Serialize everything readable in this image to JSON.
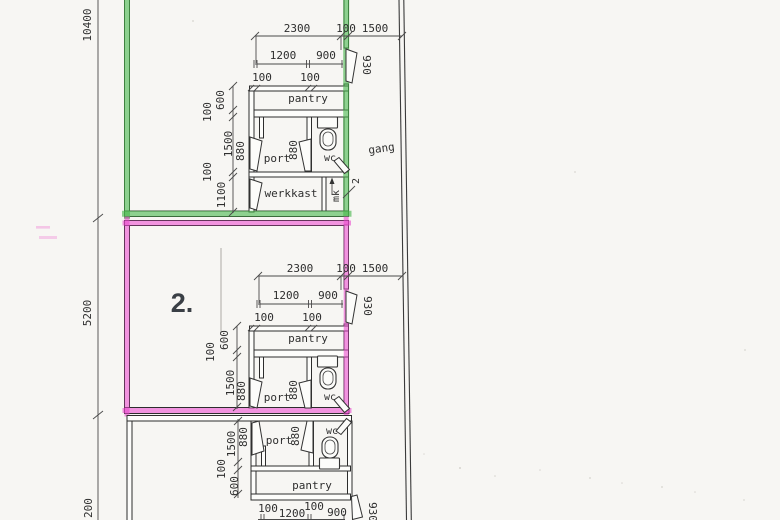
{
  "colors": {
    "green_highlight": "#48b64c",
    "pink_highlight": "#e946cb"
  },
  "left_dims": {
    "total_height": "10400",
    "unit2_height": "5200",
    "unit3_partial": "200"
  },
  "corridor": {
    "label": "gang"
  },
  "unit1": {
    "dims_top": {
      "a": "2300",
      "b": "100",
      "c": "1500"
    },
    "dims_mid": {
      "a": "1200",
      "b": "900"
    },
    "dims_wall": {
      "a": "100",
      "b": "100"
    },
    "entry_door_width": "930",
    "chain": {
      "a": "600",
      "b": "100",
      "c": "1500",
      "d": "100",
      "e": "1100"
    },
    "doors_880": {
      "left": "880",
      "right": "880"
    },
    "rooms": {
      "pantry": "pantry",
      "port": "port",
      "wc": "wc",
      "werkkast": "werkkast",
      "mk": "mk",
      "mk_count": "2"
    }
  },
  "unit2": {
    "number": "2.",
    "dims_top": {
      "a": "2300",
      "b": "100",
      "c": "1500"
    },
    "dims_mid": {
      "a": "1200",
      "b": "900"
    },
    "dims_wall": {
      "a": "100",
      "b": "100"
    },
    "entry_door_width": "930",
    "chain": {
      "a": "600",
      "b": "100",
      "c": "1500"
    },
    "doors_880": {
      "left": "880",
      "right": "880"
    },
    "rooms": {
      "pantry": "pantry",
      "port": "port",
      "wc": "wc"
    }
  },
  "unit3": {
    "dims_bottom": {
      "a": "100",
      "b": "1200",
      "c": "100",
      "d": "900"
    },
    "entry_door_width": "930",
    "chain": {
      "a": "1500",
      "b": "100",
      "c": "600"
    },
    "doors_880": {
      "left": "880",
      "right": "880"
    },
    "rooms": {
      "pantry": "pantry",
      "port": "port",
      "wc": "wc"
    }
  }
}
